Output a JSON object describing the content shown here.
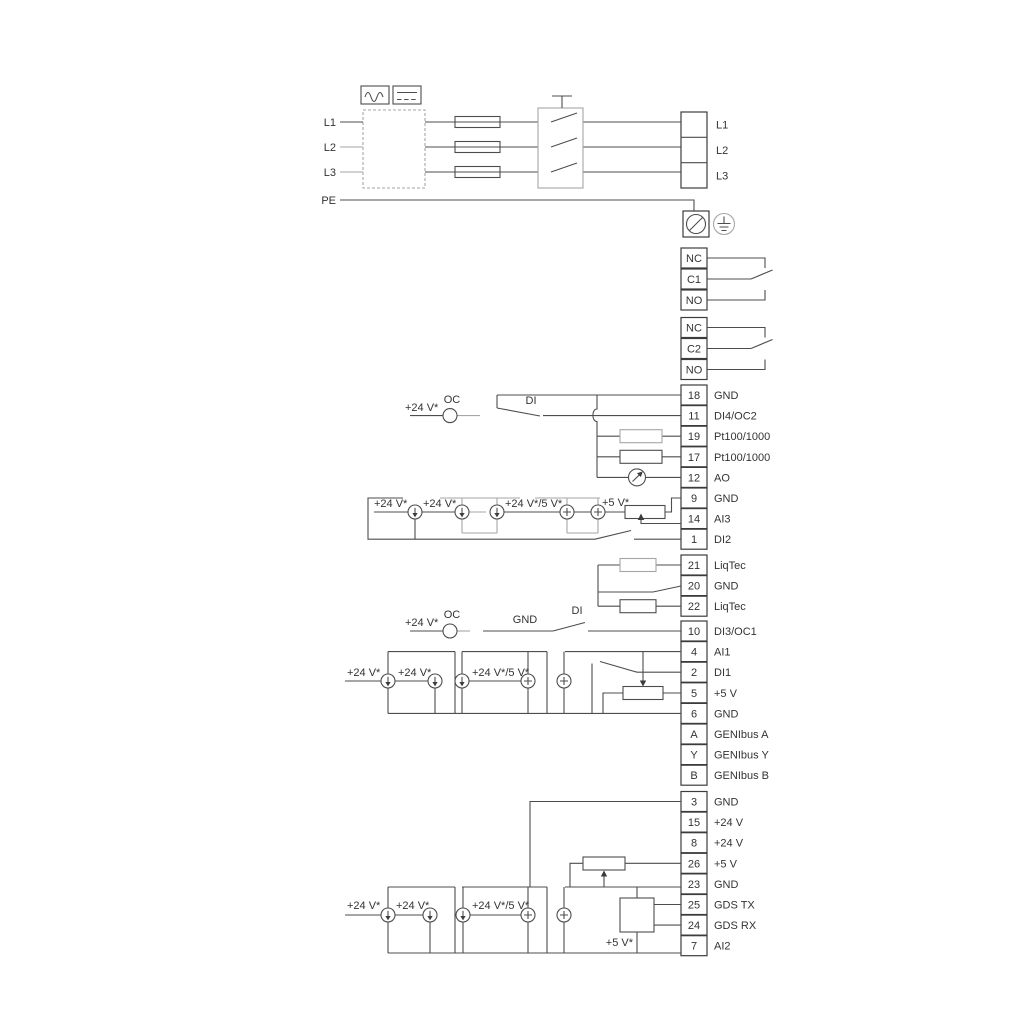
{
  "diagram_title": "Pump drive wiring diagram",
  "power": {
    "inputs": [
      "L1",
      "L2",
      "L3",
      "PE"
    ],
    "outputs": [
      "L1",
      "L2",
      "L3"
    ]
  },
  "relays": {
    "relay1": [
      "NC",
      "C1",
      "NO"
    ],
    "relay2": [
      "NC",
      "C2",
      "NO"
    ]
  },
  "io_a": {
    "rows": [
      {
        "num": "18",
        "label": "GND"
      },
      {
        "num": "11",
        "label": "DI4/OC2"
      },
      {
        "num": "19",
        "label": "Pt100/1000"
      },
      {
        "num": "17",
        "label": "Pt100/1000"
      },
      {
        "num": "12",
        "label": "AO"
      },
      {
        "num": "9",
        "label": "GND"
      },
      {
        "num": "14",
        "label": "AI3"
      },
      {
        "num": "1",
        "label": "DI2"
      }
    ]
  },
  "io_b": {
    "rows": [
      {
        "num": "21",
        "label": "LiqTec"
      },
      {
        "num": "20",
        "label": "GND"
      },
      {
        "num": "22",
        "label": "LiqTec"
      }
    ]
  },
  "io_c": {
    "rows": [
      {
        "num": "10",
        "label": "DI3/OC1"
      },
      {
        "num": "4",
        "label": "AI1"
      },
      {
        "num": "2",
        "label": "DI1"
      },
      {
        "num": "5",
        "label": "+5 V"
      },
      {
        "num": "6",
        "label": "GND"
      },
      {
        "num": "A",
        "label": "GENIbus A"
      },
      {
        "num": "Y",
        "label": "GENIbus Y"
      },
      {
        "num": "B",
        "label": "GENIbus B"
      }
    ]
  },
  "io_d": {
    "rows": [
      {
        "num": "3",
        "label": "GND"
      },
      {
        "num": "15",
        "label": "+24 V"
      },
      {
        "num": "8",
        "label": "+24 V"
      },
      {
        "num": "26",
        "label": "+5 V"
      },
      {
        "num": "23",
        "label": "GND"
      },
      {
        "num": "25",
        "label": "GDS TX"
      },
      {
        "num": "24",
        "label": "GDS RX"
      },
      {
        "num": "7",
        "label": "AI2"
      }
    ]
  },
  "wire_labels": {
    "v24": "+24 V*",
    "v24_5": "+24 V*/5 V*",
    "v5": "+5 V*",
    "oc": "OC",
    "di": "DI",
    "gnd": "GND"
  },
  "colors": {
    "line": "#4d4d4d",
    "gray": "#a6a6a6",
    "text": "#333333"
  }
}
